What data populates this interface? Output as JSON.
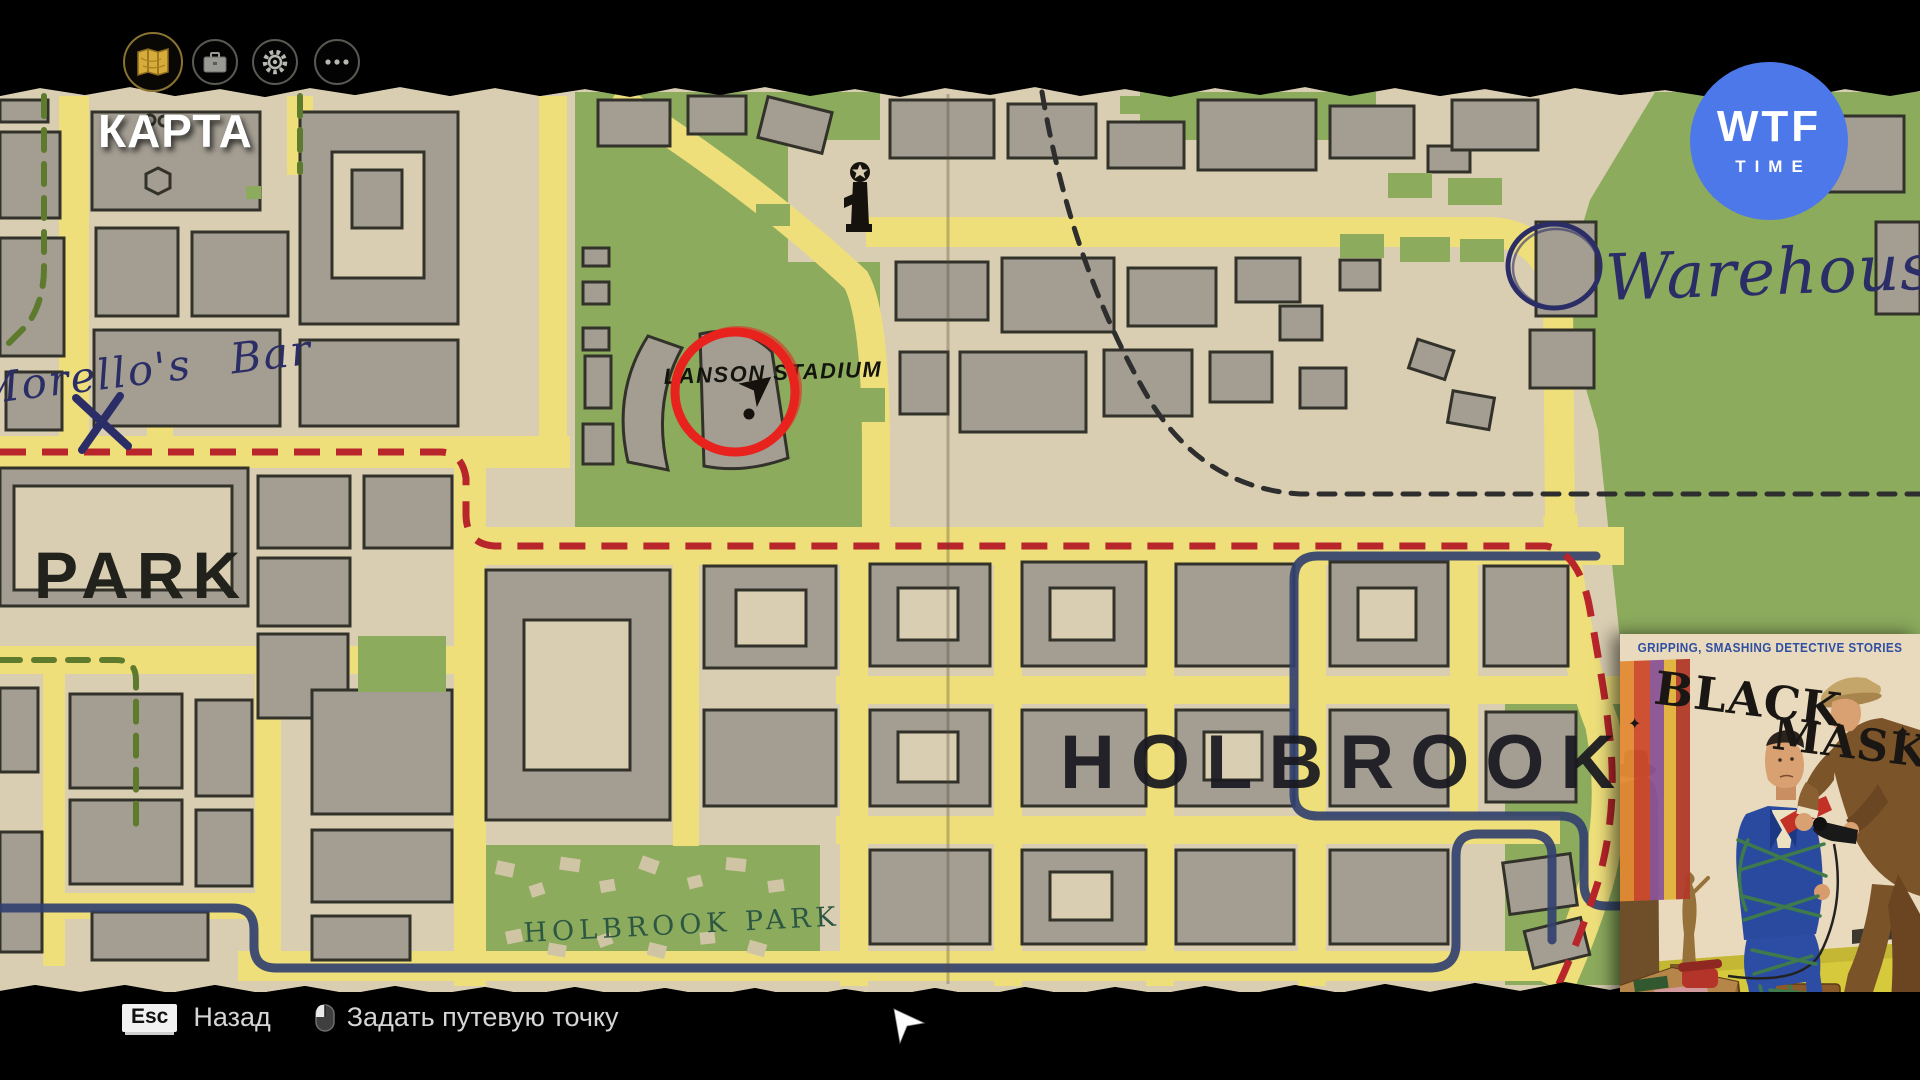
{
  "topbar": {
    "title": "КАРТА",
    "icons": [
      {
        "name": "map",
        "active": true
      },
      {
        "name": "inventory",
        "active": false
      },
      {
        "name": "settings",
        "active": false
      },
      {
        "name": "more",
        "active": false
      }
    ]
  },
  "overlay_logo": {
    "line1": "WTF",
    "line2": "TIME",
    "color": "#4d78ea"
  },
  "map": {
    "labels": {
      "district_left": "PARK",
      "district_right": "HOLBROOK",
      "park": "HOLBROOK PARK",
      "stadium": "LANSON STADIUM",
      "bar": "Morello's Bar",
      "warehouse": "Warehouse"
    },
    "colors": {
      "paper": "#d9cdb2",
      "road": "#eedf7b",
      "building": "#a39d92",
      "park_green": "#8cab5d",
      "route_red": "#b8252b",
      "route_navy": "#32416f",
      "route_green": "#5e7a2d",
      "route_black": "#2e2e2e",
      "highlight_red": "#e8231d",
      "ink_navy": "#2b2e66"
    }
  },
  "magazine": {
    "tagline": "GRIPPING, SMASHING DETECTIVE STORIES",
    "title_word1": "BLACK",
    "title_word2": "MASK",
    "star": "✦",
    "caption": "\"STAG PARTY\""
  },
  "bottombar": {
    "esc_key": "Esc",
    "back_label": "Назад",
    "waypoint_label": "Задать путевую точку"
  }
}
